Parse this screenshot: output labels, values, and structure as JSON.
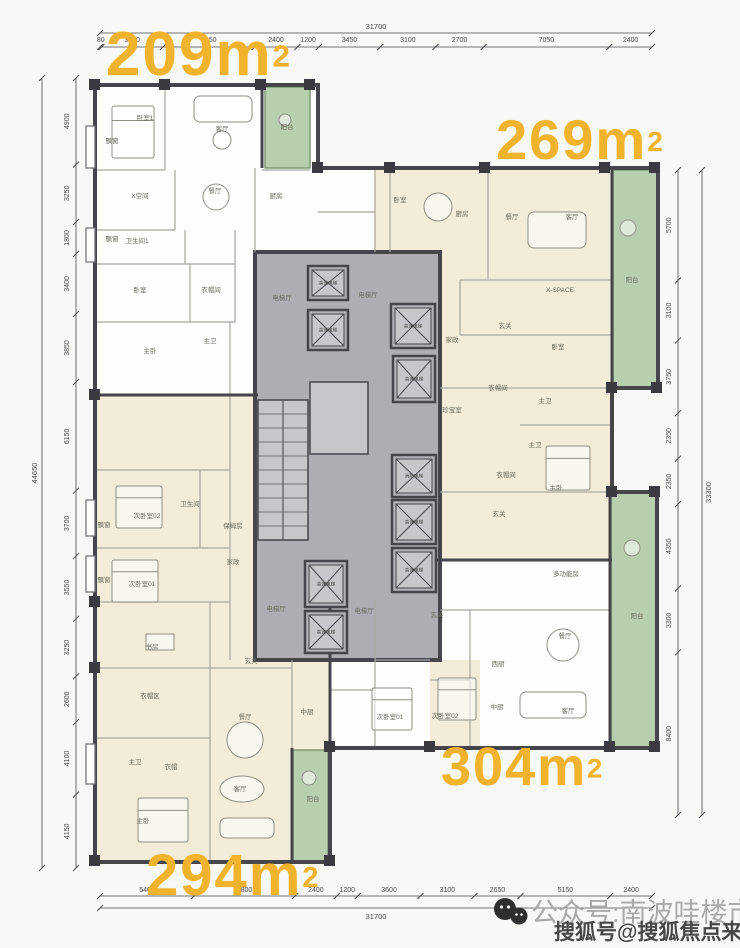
{
  "palette": {
    "yellow": "#F1B32B",
    "cream": "#F2ECD8",
    "green": "#B7CFAE",
    "green_border": "#7E9A74",
    "core": "#ADADB3",
    "core_inner": "#C6C6CB",
    "wall": "#45454B",
    "thin": "#A8A8A0",
    "label": "#6A6A5E",
    "dim": "#4A4A4D",
    "white": "#FEFEFD",
    "shaft": "#B2B2B8"
  },
  "area_labels": [
    {
      "id": "209",
      "value": "209m",
      "sup": "2"
    },
    {
      "id": "269",
      "value": "269m",
      "sup": "2"
    },
    {
      "id": "304",
      "value": "304m",
      "sup": "2"
    },
    {
      "id": "294",
      "value": "294m",
      "sup": "2"
    }
  ],
  "watermark": {
    "line1": "公众号:南波哇楼市",
    "line2": "搜狐号@搜狐焦点来宾站",
    "icon": "wechat-icon"
  },
  "dims": {
    "top": {
      "segments": [
        "80",
        "3450",
        "5150",
        "2400",
        "1200",
        "3450",
        "3100",
        "2700",
        "7050",
        "2400"
      ],
      "total": "31700"
    },
    "bottom": {
      "segments": [
        "5400",
        "5800",
        "2400",
        "1200",
        "3600",
        "3100",
        "2650",
        "5150",
        "2400"
      ],
      "total": "31700"
    },
    "left": {
      "segments": [
        "4900",
        "3250",
        "1800",
        "3400",
        "3850",
        "6150",
        "3700",
        "3550",
        "3250",
        "2600",
        "4100",
        "4150"
      ],
      "total": "44650"
    },
    "right": {
      "segments": [
        "5700",
        "3100",
        "3750",
        "2350",
        "2350",
        "4350",
        "3300",
        "8400"
      ],
      "total": "33300"
    }
  },
  "plan": {
    "outline": "95,85 318,85 318,168 658,168 658,388 612,388 612,492 657,492 657,748 330,748 330,862 95,862",
    "zones_cream": [
      [
        375,
        168,
        237,
        220
      ],
      [
        430,
        388,
        182,
        172
      ],
      [
        95,
        395,
        235,
        467
      ],
      [
        430,
        660,
        50,
        88
      ]
    ],
    "balconies": [
      [
        265,
        87,
        45,
        81
      ],
      [
        613,
        170,
        45,
        218
      ],
      [
        611,
        493,
        46,
        255
      ],
      [
        293,
        750,
        35,
        112
      ]
    ],
    "core": [
      255,
      252,
      185,
      408
    ],
    "service": [
      310,
      382,
      58,
      72
    ],
    "stairs": {
      "x": 258,
      "y": 400,
      "w": 50,
      "h": 140,
      "steps": 10
    },
    "walls_thin": [
      [
        165,
        85,
        165,
        170
      ],
      [
        95,
        170,
        165,
        170
      ],
      [
        95,
        230,
        175,
        230
      ],
      [
        175,
        170,
        175,
        230
      ],
      [
        95,
        264,
        235,
        264
      ],
      [
        185,
        230,
        185,
        264
      ],
      [
        95,
        322,
        235,
        322
      ],
      [
        190,
        264,
        190,
        322
      ],
      [
        235,
        230,
        235,
        322
      ],
      [
        230,
        322,
        230,
        395
      ],
      [
        255,
        168,
        255,
        252
      ],
      [
        262,
        170,
        310,
        170
      ],
      [
        375,
        168,
        375,
        252
      ],
      [
        318,
        212,
        375,
        212
      ],
      [
        390,
        168,
        390,
        252
      ],
      [
        488,
        168,
        488,
        280
      ],
      [
        460,
        280,
        612,
        280
      ],
      [
        460,
        335,
        612,
        335
      ],
      [
        460,
        280,
        460,
        335
      ],
      [
        440,
        388,
        612,
        388
      ],
      [
        520,
        425,
        612,
        425
      ],
      [
        440,
        492,
        610,
        492
      ],
      [
        440,
        610,
        610,
        610
      ],
      [
        470,
        610,
        470,
        748
      ],
      [
        430,
        680,
        470,
        680
      ],
      [
        375,
        600,
        375,
        748
      ],
      [
        330,
        690,
        375,
        690
      ],
      [
        375,
        660,
        430,
        660
      ],
      [
        95,
        470,
        230,
        470
      ],
      [
        95,
        548,
        230,
        548
      ],
      [
        200,
        470,
        200,
        548
      ],
      [
        230,
        395,
        230,
        660
      ],
      [
        95,
        602,
        230,
        602
      ],
      [
        95,
        668,
        210,
        668
      ],
      [
        210,
        602,
        210,
        668
      ],
      [
        95,
        738,
        210,
        738
      ],
      [
        210,
        668,
        210,
        862
      ],
      [
        210,
        668,
        292,
        668
      ],
      [
        292,
        660,
        292,
        748
      ]
    ],
    "walls_dark": [
      [
        95,
        395,
        258,
        395
      ],
      [
        430,
        560,
        612,
        560
      ],
      [
        262,
        85,
        262,
        168
      ],
      [
        612,
        170,
        612,
        388
      ],
      [
        610,
        492,
        610,
        748
      ],
      [
        292,
        748,
        292,
        862
      ],
      [
        330,
        600,
        330,
        748
      ]
    ],
    "bays": [
      [
        86,
        126,
        9,
        42
      ],
      [
        86,
        228,
        9,
        34
      ],
      [
        86,
        500,
        9,
        36
      ],
      [
        86,
        556,
        9,
        36
      ],
      [
        86,
        744,
        9,
        40
      ]
    ],
    "columns": [
      [
        90,
        80
      ],
      [
        160,
        80
      ],
      [
        256,
        80
      ],
      [
        305,
        80
      ],
      [
        313,
        163
      ],
      [
        385,
        163
      ],
      [
        480,
        163
      ],
      [
        600,
        163
      ],
      [
        650,
        163
      ],
      [
        652,
        383
      ],
      [
        607,
        383
      ],
      [
        607,
        487
      ],
      [
        650,
        487
      ],
      [
        650,
        742
      ],
      [
        605,
        742
      ],
      [
        425,
        742
      ],
      [
        325,
        742
      ],
      [
        325,
        856
      ],
      [
        90,
        856
      ],
      [
        90,
        390
      ],
      [
        90,
        597
      ],
      [
        90,
        663
      ]
    ],
    "elevators": [
      {
        "x": 308,
        "y": 266,
        "w": 40,
        "h": 34,
        "label": "高速电梯"
      },
      {
        "x": 308,
        "y": 310,
        "w": 40,
        "h": 40,
        "label": "高速电梯"
      },
      {
        "x": 391,
        "y": 304,
        "w": 44,
        "h": 44,
        "label": "高速电梯"
      },
      {
        "x": 393,
        "y": 356,
        "w": 42,
        "h": 46,
        "label": "高速电梯"
      },
      {
        "x": 392,
        "y": 455,
        "w": 44,
        "h": 42,
        "label": "消防电梯"
      },
      {
        "x": 392,
        "y": 500,
        "w": 44,
        "h": 44,
        "label": "高速电梯"
      },
      {
        "x": 392,
        "y": 548,
        "w": 44,
        "h": 44,
        "label": "高速电梯"
      },
      {
        "x": 305,
        "y": 561,
        "w": 42,
        "h": 46,
        "label": "高速电梯"
      },
      {
        "x": 305,
        "y": 611,
        "w": 42,
        "h": 42,
        "label": "高速电梯"
      }
    ],
    "furniture": [
      {
        "t": "bed",
        "x": 112,
        "y": 106,
        "w": 42,
        "h": 52
      },
      {
        "t": "sofa",
        "x": 194,
        "y": 96,
        "w": 58,
        "h": 26
      },
      {
        "t": "round",
        "x": 222,
        "y": 140,
        "r": 9
      },
      {
        "t": "round",
        "x": 216,
        "y": 197,
        "r": 13
      },
      {
        "t": "round",
        "x": 285,
        "y": 120,
        "r": 6
      },
      {
        "t": "round",
        "x": 438,
        "y": 207,
        "r": 14
      },
      {
        "t": "sofa",
        "x": 528,
        "y": 212,
        "w": 58,
        "h": 36
      },
      {
        "t": "round",
        "x": 628,
        "y": 228,
        "r": 8
      },
      {
        "t": "bed",
        "x": 546,
        "y": 446,
        "w": 44,
        "h": 44
      },
      {
        "t": "round",
        "x": 632,
        "y": 548,
        "r": 8
      },
      {
        "t": "bed",
        "x": 372,
        "y": 688,
        "w": 40,
        "h": 42
      },
      {
        "t": "bed",
        "x": 438,
        "y": 678,
        "w": 38,
        "h": 42
      },
      {
        "t": "round",
        "x": 563,
        "y": 645,
        "r": 16
      },
      {
        "t": "sofa",
        "x": 520,
        "y": 692,
        "w": 66,
        "h": 26
      },
      {
        "t": "bed",
        "x": 116,
        "y": 486,
        "w": 46,
        "h": 42
      },
      {
        "t": "bed",
        "x": 112,
        "y": 560,
        "w": 46,
        "h": 42
      },
      {
        "t": "desk",
        "x": 146,
        "y": 634,
        "w": 28,
        "h": 16
      },
      {
        "t": "round",
        "x": 245,
        "y": 740,
        "r": 18
      },
      {
        "t": "oval",
        "x": 242,
        "y": 789,
        "rx": 22,
        "ry": 13
      },
      {
        "t": "sofa",
        "x": 220,
        "y": 818,
        "w": 54,
        "h": 20
      },
      {
        "t": "bed",
        "x": 138,
        "y": 798,
        "w": 50,
        "h": 44
      },
      {
        "t": "round",
        "x": 309,
        "y": 778,
        "r": 7
      }
    ],
    "labels": [
      [
        112,
        143,
        "飘窗"
      ],
      [
        145,
        120,
        "卧室1"
      ],
      [
        222,
        131,
        "客厅"
      ],
      [
        287,
        129,
        "阳台"
      ],
      [
        140,
        198,
        "X空间"
      ],
      [
        215,
        193,
        "餐厅"
      ],
      [
        276,
        198,
        "厨房"
      ],
      [
        112,
        241,
        "飘窗"
      ],
      [
        137,
        243,
        "卫生间1"
      ],
      [
        140,
        292,
        "卧室"
      ],
      [
        211,
        292,
        "衣帽间"
      ],
      [
        150,
        353,
        "主卧"
      ],
      [
        210,
        343,
        "主卫"
      ],
      [
        400,
        202,
        "卧室"
      ],
      [
        462,
        216,
        "厨房"
      ],
      [
        512,
        219,
        "餐厅"
      ],
      [
        572,
        219,
        "客厅"
      ],
      [
        560,
        292,
        "X-SPACE"
      ],
      [
        632,
        282,
        "阳台"
      ],
      [
        452,
        342,
        "家政"
      ],
      [
        505,
        328,
        "玄关"
      ],
      [
        498,
        390,
        "衣帽间"
      ],
      [
        558,
        349,
        "卧室"
      ],
      [
        545,
        403,
        "主卫"
      ],
      [
        452,
        412,
        "珍宝室"
      ],
      [
        535,
        447,
        "主卫"
      ],
      [
        506,
        477,
        "衣帽间"
      ],
      [
        556,
        490,
        "主卧"
      ],
      [
        499,
        516,
        "玄关"
      ],
      [
        566,
        576,
        "多功能房"
      ],
      [
        637,
        618,
        "阳台"
      ],
      [
        498,
        666,
        "西厨"
      ],
      [
        497,
        709,
        "中厨"
      ],
      [
        565,
        638,
        "餐厅"
      ],
      [
        568,
        713,
        "客厅"
      ],
      [
        437,
        617,
        "玄关"
      ],
      [
        445,
        718,
        "次卧室02"
      ],
      [
        390,
        719,
        "次卧室01"
      ],
      [
        282,
        300,
        "电梯厅"
      ],
      [
        368,
        297,
        "电梯厅"
      ],
      [
        276,
        611,
        "电梯厅"
      ],
      [
        364,
        613,
        "电梯厅"
      ],
      [
        147,
        518,
        "次卧室02"
      ],
      [
        190,
        506,
        "卫生间"
      ],
      [
        233,
        528,
        "保姆房"
      ],
      [
        233,
        564,
        "家政"
      ],
      [
        104,
        527,
        "飘窗"
      ],
      [
        104,
        582,
        "飘窗"
      ],
      [
        142,
        586,
        "次卧室01"
      ],
      [
        152,
        649,
        "书房"
      ],
      [
        150,
        698,
        "衣帽区"
      ],
      [
        251,
        663,
        "玄关"
      ],
      [
        135,
        764,
        "主卫"
      ],
      [
        171,
        769,
        "衣帽"
      ],
      [
        143,
        823,
        "主卧"
      ],
      [
        245,
        719,
        "餐厅"
      ],
      [
        240,
        791,
        "客厅"
      ],
      [
        307,
        714,
        "中厨"
      ],
      [
        313,
        801,
        "阳台"
      ]
    ]
  }
}
